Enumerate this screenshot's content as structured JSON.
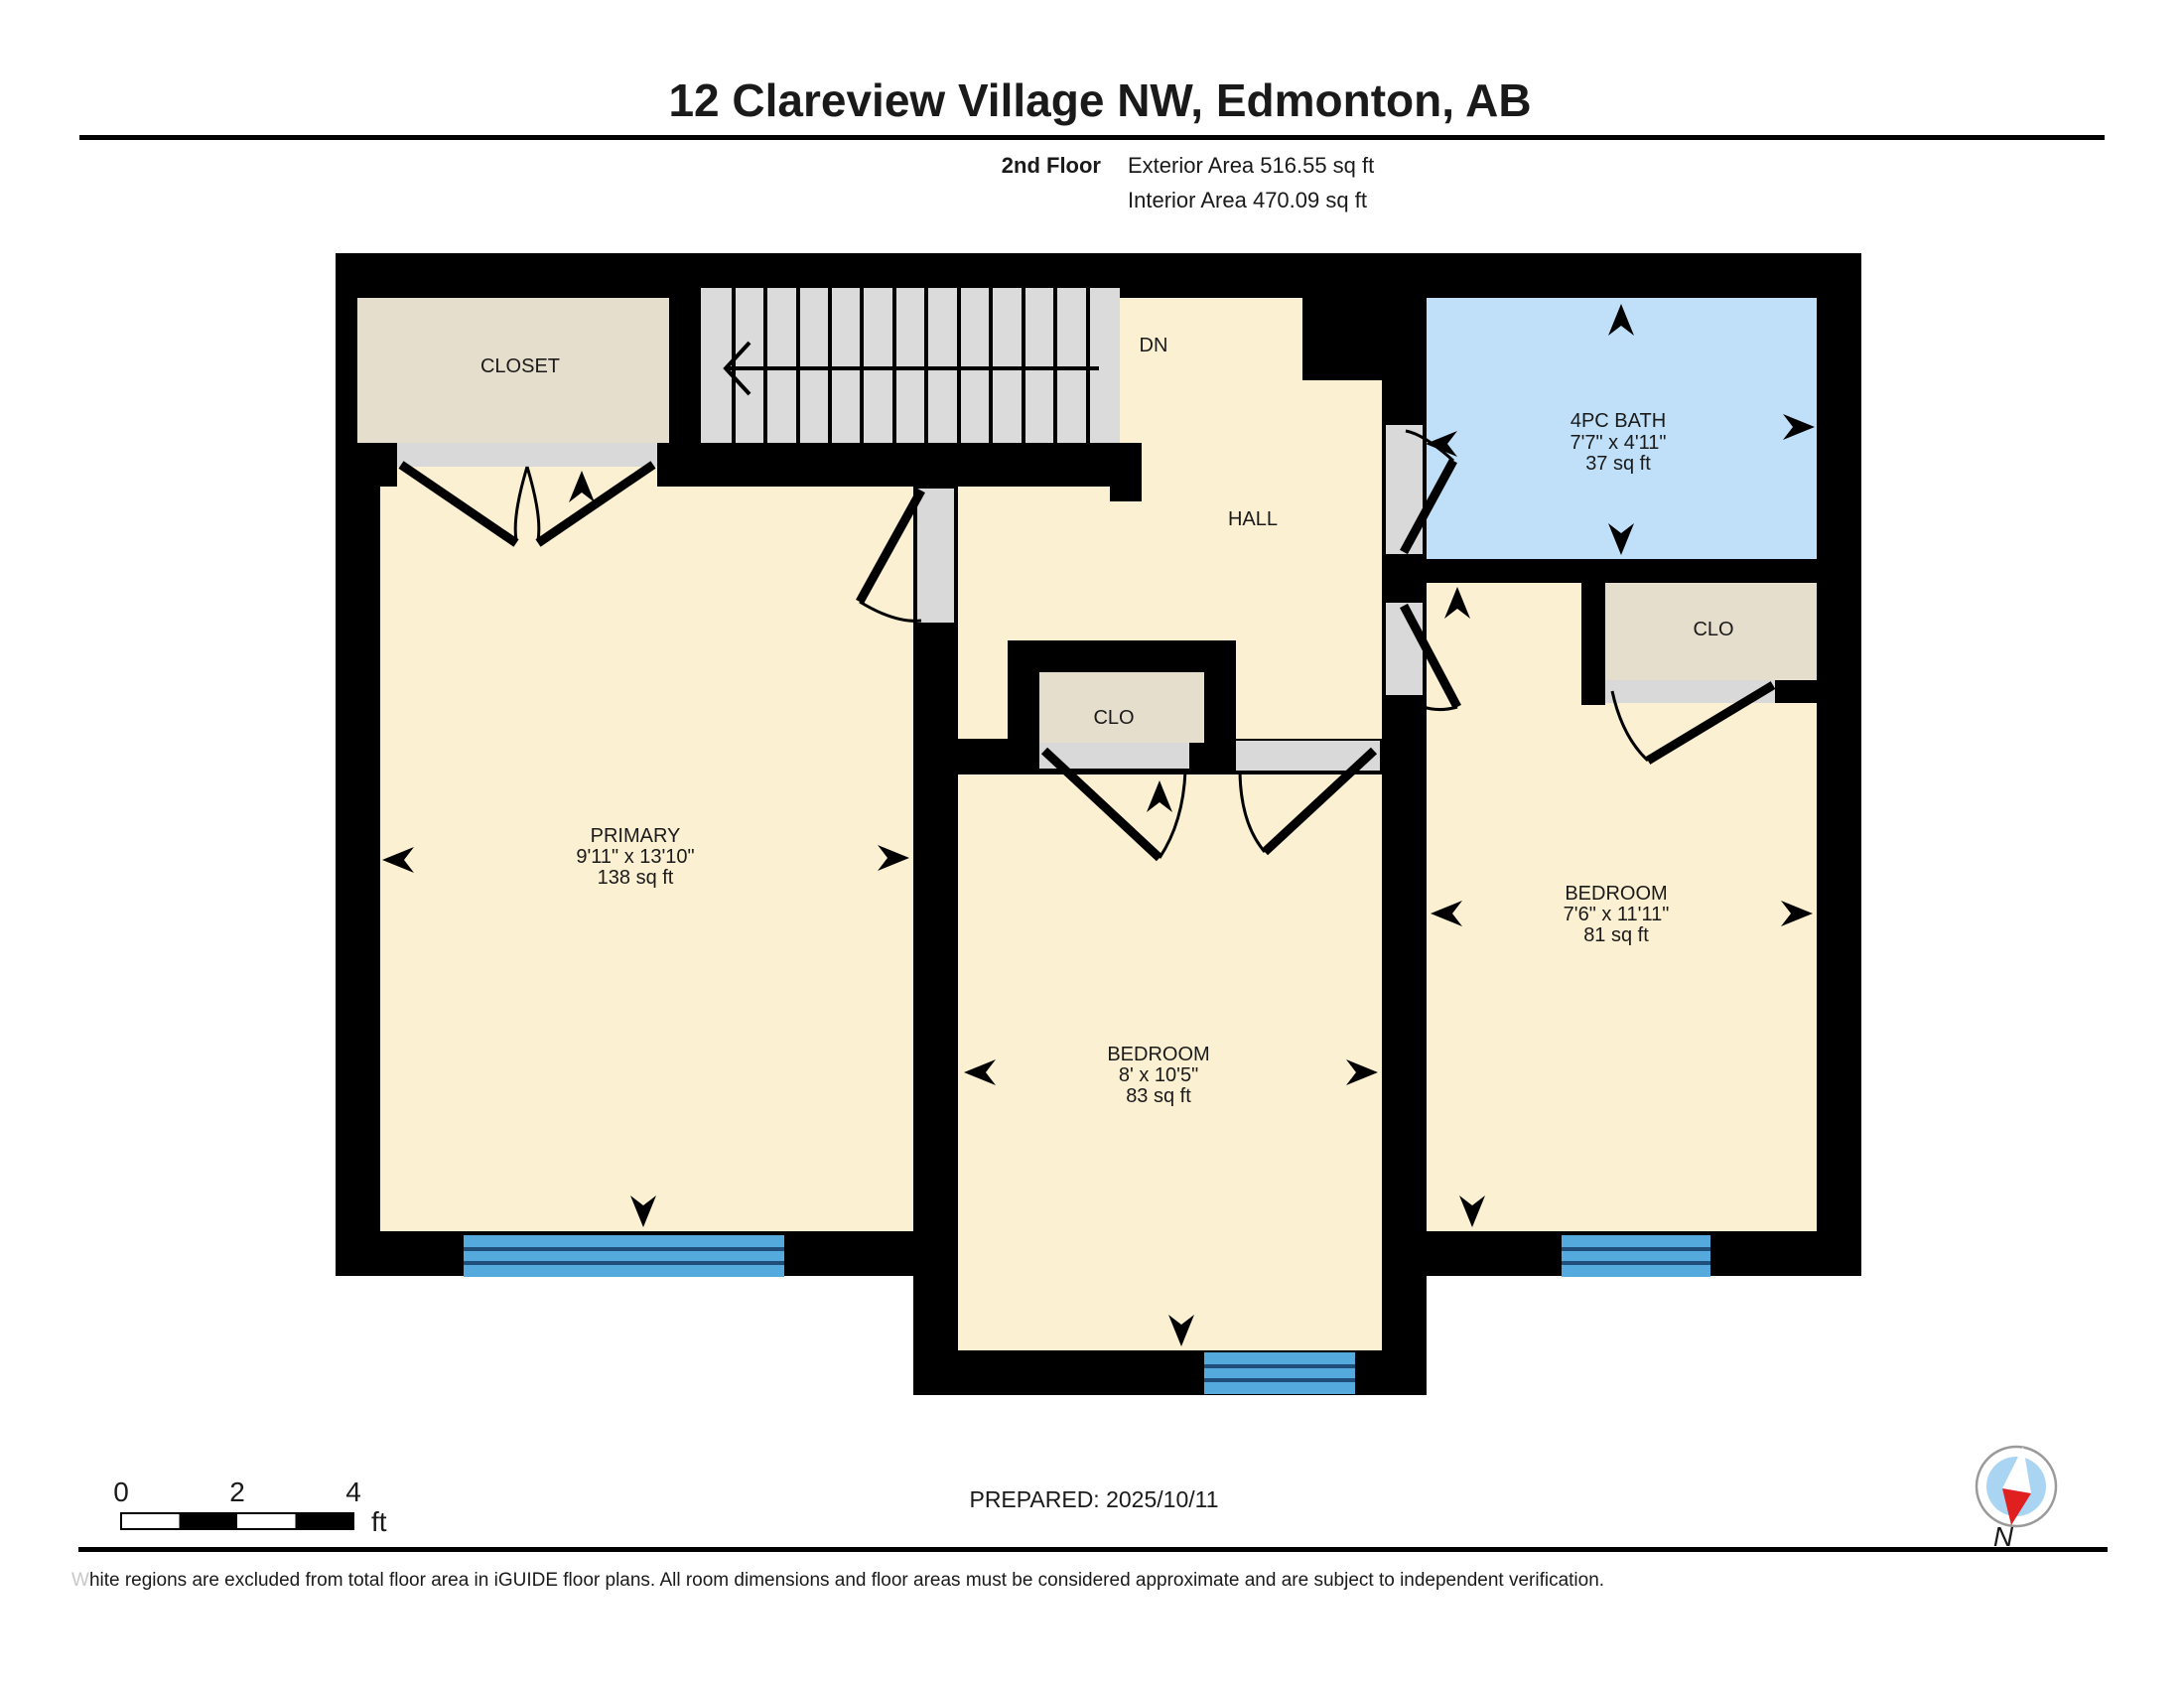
{
  "header": {
    "title": "12 Clareview Village NW, Edmonton, AB",
    "floor_label": "2nd Floor",
    "exterior_area": "Exterior Area 516.55 sq ft",
    "interior_area": "Interior Area 470.09 sq ft"
  },
  "plan": {
    "closet_label": "CLOSET",
    "stairs_direction": "DN",
    "hall_label": "HALL",
    "bath": {
      "name": "4PC BATH",
      "dims": "7'7\" x 4'11\"",
      "area": "37 sq ft"
    },
    "closet_right_label": "CLO",
    "closet_hall_label": "CLO",
    "primary": {
      "name": "PRIMARY",
      "dims": "9'11\" x 13'10\"",
      "area": "138 sq ft"
    },
    "bedroom_middle": {
      "name": "BEDROOM",
      "dims": "8' x 10'5\"",
      "area": "83 sq ft"
    },
    "bedroom_right": {
      "name": "BEDROOM",
      "dims": "7'6\" x 11'11\"",
      "area": "81 sq ft"
    }
  },
  "footer": {
    "scale_ticks": [
      "0",
      "2",
      "4"
    ],
    "scale_unit": "ft",
    "prepared": "PREPARED: 2025/10/11",
    "compass_label": "N",
    "disclaimer_first_letter": "W",
    "disclaimer_rest": "hite regions are excluded from total floor area in iGUIDE floor plans. All room dimensions and floor areas must be considered approximate and are subject to independent verification."
  },
  "colors": {
    "wall": "#000000",
    "room_yellow": "#FCF0D2",
    "closet_beige": "#E6DECC",
    "stairs_gray": "#DBDBDB",
    "door_gray": "#D9D9D9",
    "bath_blue": "#BFE0F8",
    "window_blue": "#54A9DD",
    "window_line": "#1E4E79",
    "compass_ring": "#9A9A9A",
    "compass_inner": "#A9D5F2",
    "compass_needle_red": "#E01F1F"
  }
}
